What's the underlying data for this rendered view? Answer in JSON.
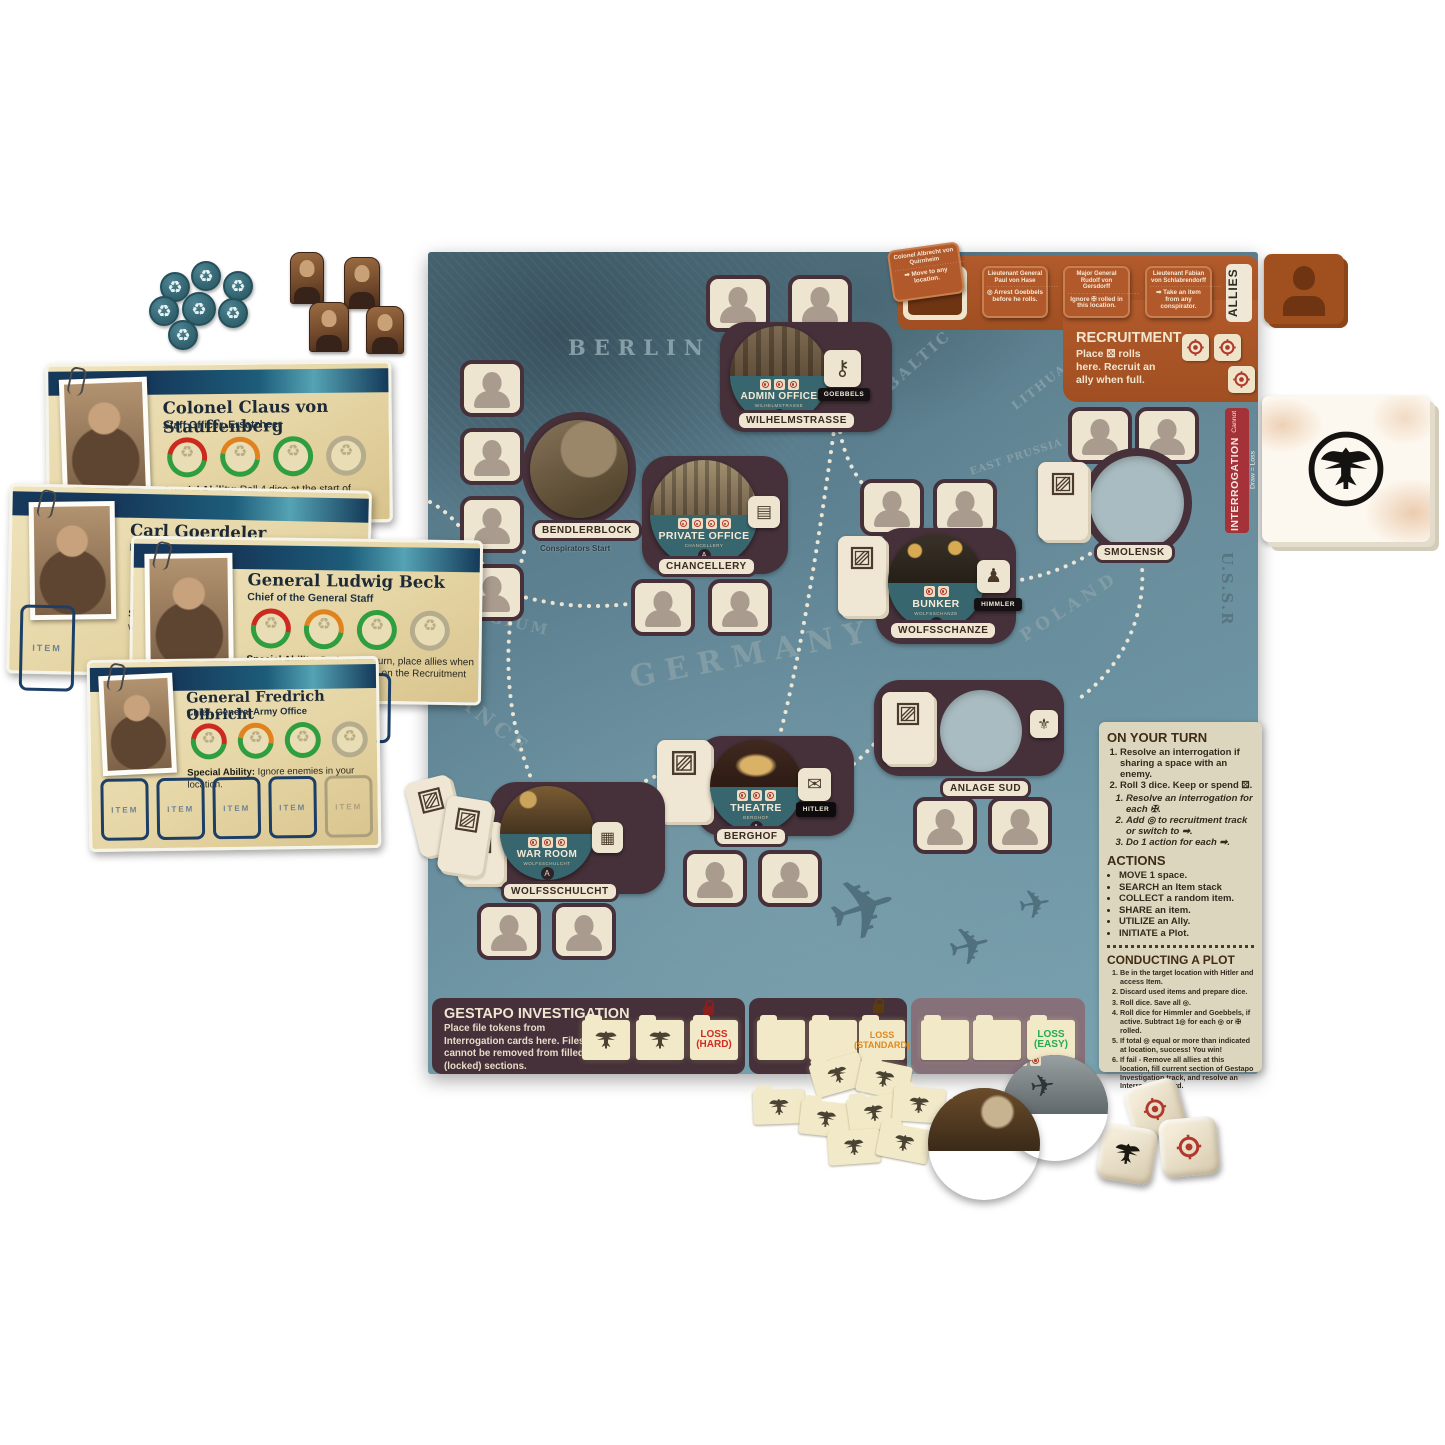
{
  "colors": {
    "board_teal": "#5d8191",
    "plate_maroon": "#463039",
    "cream": "#efe6d2",
    "ally_brown": "#b2592b",
    "interrogation_red": "#a43238",
    "band_teal": "#37666e",
    "loss_hard": "#d42a20",
    "loss_standard": "#e08a1e",
    "loss_easy": "#1fae4e"
  },
  "item_label": "ITEM",
  "player_cards": [
    {
      "name": "Colonel Claus von Stauffenberg",
      "title": "Staff Officer, Ersatzheer",
      "ability_label": "Special Ability:",
      "ability_text": "Roll 4 dice at the start of your turn instead of 3."
    },
    {
      "name": "Carl Goerdeler",
      "title": "Politician & Businessman",
      "ability_label": "Special",
      "ability_text": "when pe"
    },
    {
      "name": "General Ludwig Beck",
      "title": "Chief of the General Staff",
      "ability_label": "Special Ability:",
      "ability_text": "During your turn, place allies when you have ◎◎ instead of three on the Recruitment Track."
    },
    {
      "name": "General Fredrich Olbricht",
      "title": "Chief, General Army Office",
      "ability_label": "Special Ability:",
      "ability_text": "Ignore enemies in your location."
    }
  ],
  "map_labels": {
    "berlin": "BERLIN",
    "belgium": "BELGIUM",
    "germany": "GERMANY",
    "france": "FRANCE",
    "baltic": "BALTIC SEA",
    "lithuania": "LITHUANIA",
    "east_prussia": "EAST PRUSSIA",
    "poland": "POLAND",
    "cze": "CZE",
    "ussr": "U.S.S.R"
  },
  "locations": {
    "admin": {
      "name": "ADMIN OFFICE",
      "sub": "WILHELMSTRASSE",
      "letter": "A",
      "label": "WILHELMSTRASSE",
      "tag": "GOEBBELS"
    },
    "bendlerblock": {
      "label": "BENDLERBLOCK",
      "sub": "Conspirators Start"
    },
    "private": {
      "name": "PRIVATE OFFICE",
      "sub": "CHANCELLERY",
      "letter": "A",
      "label": "CHANCELLERY"
    },
    "bunker": {
      "name": "BUNKER",
      "sub": "WOLFSSCHANZE",
      "letter": "A",
      "label": "WOLFSSCHANZE",
      "tag": "HIMMLER"
    },
    "smolensk": {
      "label": "SMOLENSK"
    },
    "anlage": {
      "label": "ANLAGE SUD"
    },
    "theatre": {
      "name": "THEATRE",
      "sub": "BERGHOF",
      "letter": "A",
      "label": "BERGHOF",
      "tag": "HITLER"
    },
    "warroom": {
      "name": "WAR ROOM",
      "sub": "WOLFSSCHULCHT",
      "letter": "A",
      "label": "WOLFSSCHULCHT"
    }
  },
  "loose_tokens": {
    "map_room": {
      "name": "MAP ROOM",
      "sub": "ANLAGE SUD",
      "letter": "A"
    },
    "airplane": {
      "name": "AIRPLANE",
      "sub": "SMOLENSK",
      "letter": "B"
    }
  },
  "allies": {
    "title": "ALLIES",
    "cards": [
      {
        "name": "Colonel Albrecht von Quirnheim",
        "ability": "Move to any location."
      },
      {
        "name": "Lieutenant General Paul von Hase",
        "ability": "Arrest Goebbels before he rolls."
      },
      {
        "name": "Major General Rudolf von Gersdorff",
        "ability": "Ignore ✠ rolled in this location."
      },
      {
        "name": "Lieutenant Fabian von Schlabrendorff",
        "ability": "Take an item from any conspirator."
      }
    ]
  },
  "recruitment": {
    "title": "RECRUITMENT",
    "text": "Place ⚄ rolls here. Recruit an ally when full."
  },
  "interrogation": {
    "title": "INTERROGATION",
    "subtitle": "Cannot Draw = Loss"
  },
  "turn_panel": {
    "heading": "ON YOUR TURN",
    "steps": [
      "Resolve an interrogation if sharing a space with an enemy.",
      "Roll 3 dice. Keep or spend ⚄."
    ],
    "substeps": [
      "Resolve an interrogation for each ✠.",
      "Add ◎ to recruitment track or switch to ➡.",
      "Do 1 action for each ➡."
    ],
    "actions_heading": "ACTIONS",
    "actions": [
      "MOVE 1 space.",
      "SEARCH an Item stack",
      "COLLECT a random item.",
      "SHARE an item.",
      "UTILIZE an Ally.",
      "INITIATE a Plot."
    ],
    "plot_heading": "CONDUCTING A PLOT",
    "plot_steps": [
      "Be in the target location with Hitler and access Item.",
      "Discard used items and prepare dice.",
      "Roll dice. Save all ◎.",
      "Roll dice for Himmler and Goebbels, if active. Subtract 1◎ for each ◎ or ✠ rolled.",
      "If total ◎ equal or more than indicated at location, success! You win!",
      "If fail - Remove all allies at this location, fill current section of Gestapo Investigation track, and resolve an Interrogation card."
    ]
  },
  "gestapo": {
    "title": "GESTAPO INVESTIGATION",
    "text": "Place file tokens from Interrogation cards here. Files cannot be removed from filled (locked) sections.",
    "loss_hard": "LOSS (HARD)",
    "loss_standard": "LOSS (STANDARD)",
    "loss_easy": "LOSS (EASY)"
  }
}
